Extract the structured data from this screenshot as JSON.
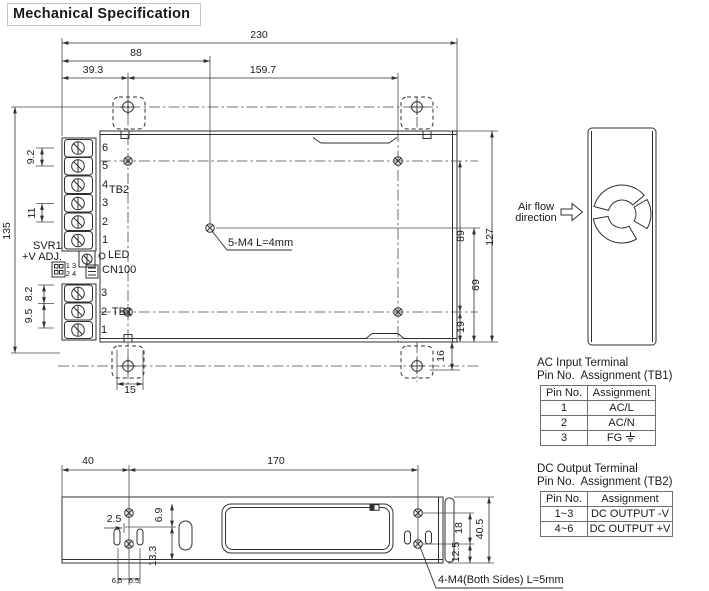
{
  "title": "Mechanical Specification",
  "colors": {
    "ink": "#2f2f2f",
    "table_border": "#6f6f6f",
    "title_border": "#c4c4c4"
  },
  "top_view": {
    "dims": {
      "overall_width": "230",
      "left_to_center": "88",
      "left_offset": "39.3",
      "hole_spacing": "159.7",
      "overall_height": "135",
      "tb2_pitch_a": "9.2",
      "tb2_pitch_b": "11",
      "tb1_pitch_a": "8.2",
      "tb1_pitch_b": "9.5",
      "bracket_width": "15",
      "bracket_height": "16",
      "right_a": "89",
      "right_b": "69",
      "right_c": "19",
      "right_overall": "127"
    },
    "tb2": {
      "label": "TB2",
      "pins": [
        "6",
        "5",
        "4",
        "3",
        "2",
        "1"
      ]
    },
    "tb1": {
      "label": "TB1",
      "pins": [
        "3",
        "2",
        "1"
      ]
    },
    "svr1_line1": "SVR1",
    "svr1_line2": "+V ADJ.",
    "led": "LED",
    "cn100": "CN100",
    "cn_pins_row1": "1 3",
    "cn_pins_row2": "2 4",
    "screw_note": "5-M4 L=4mm"
  },
  "side_view": {
    "airflow_label_line1": "Air flow",
    "airflow_label_line2": "direction"
  },
  "bottom_view": {
    "dims": {
      "left_to_hole": "40",
      "hole_spacing": "170",
      "slot_offset": "2.5",
      "edge_a": "6.9",
      "edge_b": "13.3",
      "slot_pitch_a": "6.5",
      "slot_pitch_b": "6.5",
      "hole_pitch": "18",
      "hole_to_edge": "12.5",
      "overall_height": "40.5"
    },
    "screw_note": "4-M4(Both Sides) L=5mm"
  },
  "tables": {
    "ac": {
      "title": "AC Input Terminal",
      "subtitle": "Pin No.  Assignment (TB1)",
      "headers": {
        "pin": "Pin No.",
        "assignment": "Assignment"
      },
      "rows": [
        {
          "pin": "1",
          "assignment": "AC/L"
        },
        {
          "pin": "2",
          "assignment": "AC/N"
        },
        {
          "pin": "3",
          "assignment": "FG"
        }
      ]
    },
    "dc": {
      "title": "DC Output Terminal",
      "subtitle": "Pin No.  Assignment (TB2)",
      "headers": {
        "pin": "Pin No.",
        "assignment": "Assignment"
      },
      "rows": [
        {
          "pin": "1~3",
          "assignment": "DC OUTPUT -V"
        },
        {
          "pin": "4~6",
          "assignment": "DC OUTPUT +V"
        }
      ]
    }
  }
}
